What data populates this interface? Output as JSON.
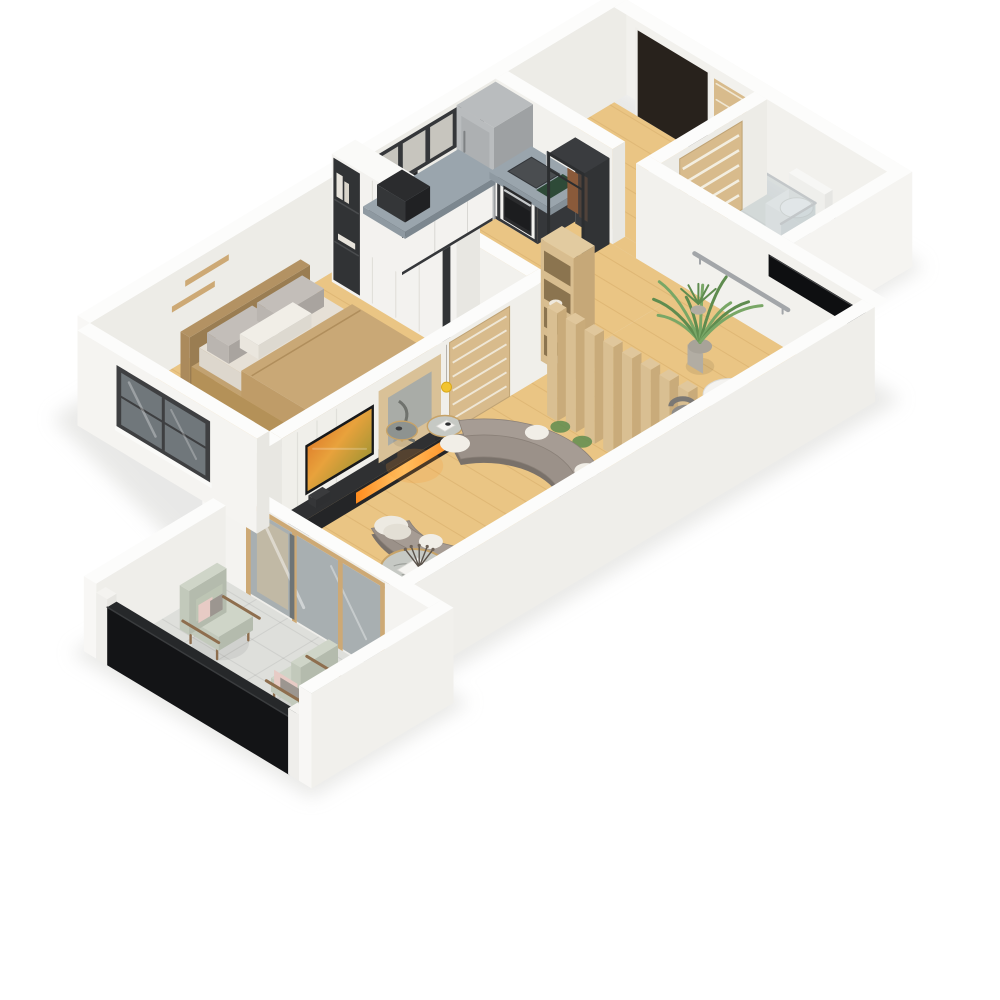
{
  "scene": {
    "title": "isometric-3d-apartment-floor-plan-render",
    "background": "#ffffff",
    "palette": {
      "shadow": "#d7d7d4",
      "floor_wood": "#eac584",
      "floor_wood_line": "#c89b58",
      "floor_tile": "#e7e8e4",
      "floor_tile_line": "#d0d1cd",
      "balcony_tile": "#dedfdb",
      "wall_cap": "#fcfcfb",
      "wall_face": "#e8e7e2",
      "wall_face_light": "#f5f4f1",
      "wall_int": "#edece7",
      "wall_int_light": "#f2f1ed",
      "wall_bright": "#f8f7f5",
      "media_wall": "#f0efea",
      "frame_dark": "#35373a",
      "cabinet_white": "#f3f2ef",
      "counter": "#8e99a1",
      "counter_top": "#9aa5ad",
      "steel": "#b9bcbe",
      "steel_dark": "#9ea1a3",
      "black": "#0e0f11",
      "door_dark": "#28221c",
      "wood_door": "#d8bb8c",
      "wood_tan": "#cda975",
      "wood_slat": "#e0c79c",
      "sofa": "#9b9189",
      "sofa_back": "#a69c94",
      "sofa_base": "#79716a",
      "pillow_white": "#f1eee7",
      "bed_frame": "#b39263",
      "duvet": "#c9a876",
      "mattress": "#e6e0d6",
      "pillow_gray": "#c3beb9",
      "rug": "#cbc9c3",
      "rug_line": "#aeaca6",
      "marble": "#c6c9c4",
      "marble_dark": "#8e9390",
      "gold": "#c7a368",
      "green": "#5f8c4f",
      "green_light": "#79a766",
      "pot": "#b2ada3",
      "chair_sage": "#cfd5c8",
      "chair_wood": "#8e6e4e",
      "pillow_pink": "#e7cbc5",
      "glass": "rgba(183,195,199,0.42)",
      "glass_door": "#a8afb1",
      "rail_gray": "#a3a6a9",
      "fire_a": "#ff8c1e",
      "fire_b": "#ffc66a",
      "tv_a": "#d8641e",
      "tv_b": "#7a8c2e",
      "lamp_yellow": "#f2c430",
      "window_glass": "#70777b",
      "window_frame": "#3e3f41"
    },
    "rooms": [
      {
        "id": "bedroom",
        "label": "Bedroom",
        "furniture": [
          "double-bed",
          "wardrobe",
          "floating-shelves",
          "area-rug",
          "window",
          "potted-plant",
          "floor-decor"
        ]
      },
      {
        "id": "kitchen",
        "label": "Kitchen",
        "furniture": [
          "upper-cabinets",
          "base-cabinets",
          "tall-steel-cabinet",
          "sink",
          "oven",
          "microwave",
          "cutting-board",
          "pantry-rack"
        ]
      },
      {
        "id": "hallway",
        "label": "Hallway",
        "furniture": [
          "front-door",
          "spare-door"
        ]
      },
      {
        "id": "bathroom",
        "label": "Bathroom",
        "furniture": [
          "toilet",
          "shower-glass",
          "pedestal-sink",
          "slat-door",
          "transom-window"
        ]
      },
      {
        "id": "living-room",
        "label": "Living Room",
        "furniture": [
          "media-wall",
          "tv",
          "fireplace-console",
          "art-panel",
          "pendant-lamp",
          "sliding-slat-door",
          "tall-shelf",
          "slat-partition",
          "palm-plant",
          "desk",
          "desk-chair",
          "curved-sofa",
          "side-table-1",
          "side-table-2",
          "coffee-table",
          "handrail",
          "floor-plants"
        ]
      },
      {
        "id": "balcony",
        "label": "Balcony",
        "furniture": [
          "armchair-1",
          "armchair-2",
          "glass-railing",
          "sliding-glass-doors"
        ]
      }
    ]
  }
}
